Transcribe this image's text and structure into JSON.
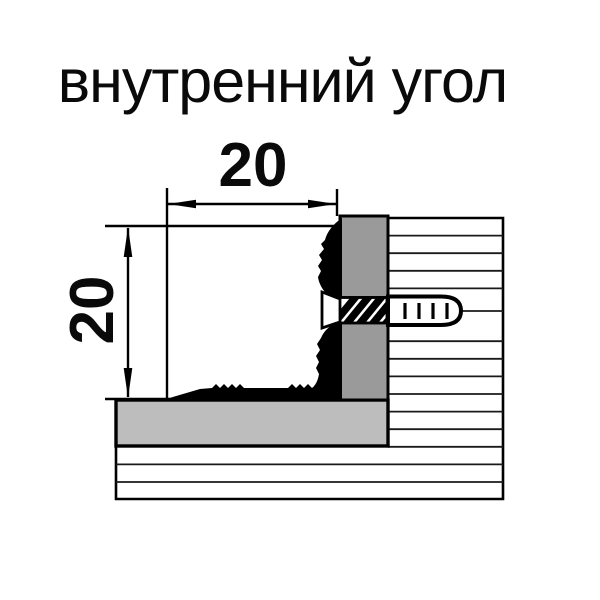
{
  "title": "внутренний угол",
  "drawing": {
    "description": "cross-section of internal corner aluminium profile mounted to wall with countersunk screw and dowel",
    "width_dim_label": "20",
    "height_dim_label": "20"
  },
  "colors": {
    "background": "#ffffff",
    "outline": "#000000",
    "profile_bar_gray": "#9a9a9a",
    "profile_base_gray": "#bdbdbd",
    "hatch_line": "#1a1a1a"
  }
}
